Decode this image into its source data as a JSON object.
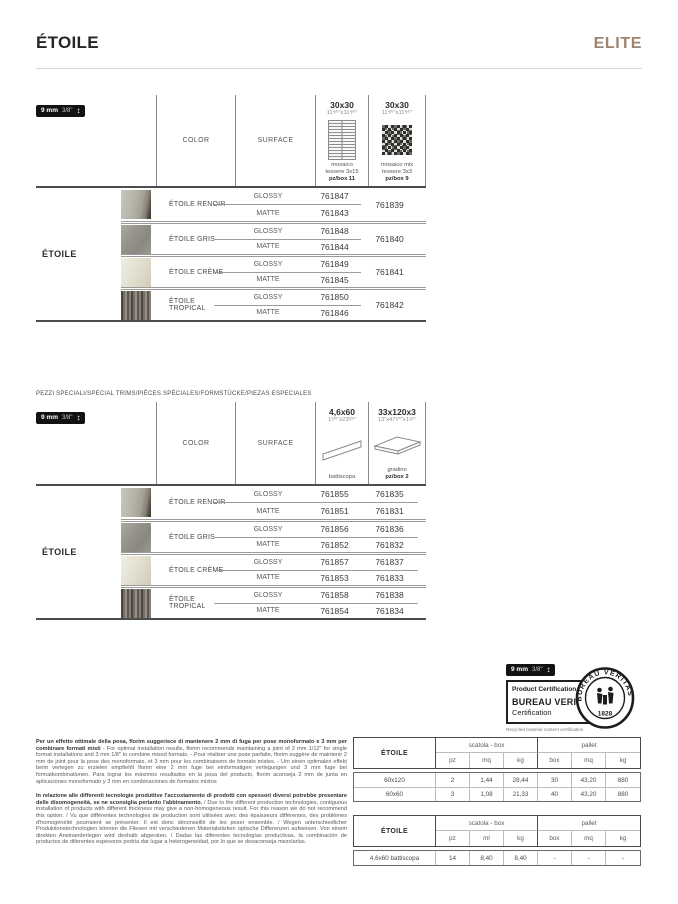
{
  "page": {
    "title": "ÉTOILE",
    "brand": "ELITE",
    "accent": "#9d8471"
  },
  "icons": {
    "thickness_arrow": "↕"
  },
  "thickness_badge": {
    "mm": "9 mm",
    "inch": "3/8\""
  },
  "labels": {
    "glossy": "GLOSSY",
    "matte": "MATTE"
  },
  "table1": {
    "series": "ÉTOILE",
    "columns": {
      "color": "COLOR",
      "surface": "SURFACE"
    },
    "formats": [
      {
        "size": "30x30",
        "inches": "11⁴⁄⁵\"x11⁴⁄⁵\"",
        "desc1": "mosaico",
        "desc2": "tessere 3x15",
        "box": "pz/box 11",
        "icon": "mosaic-strips-icon"
      },
      {
        "size": "30x30",
        "inches": "11⁴⁄⁵\"x11⁴⁄⁵\"",
        "desc1": "mosaico mix",
        "desc2": "tessere 3x3",
        "box": "pz/box 9",
        "icon": "mosaic-mix-icon"
      }
    ],
    "groups": [
      {
        "color": "ÉTOILE RENOIR",
        "swatch": "renoir",
        "glossy": "761847",
        "matte": "761843",
        "shared": "761839"
      },
      {
        "color": "ÉTOILE GRIS",
        "swatch": "gris",
        "glossy": "761848",
        "matte": "761844",
        "shared": "761840"
      },
      {
        "color": "ÉTOILE CRÈME",
        "swatch": "creme",
        "glossy": "761849",
        "matte": "761845",
        "shared": "761841"
      },
      {
        "color": "ÉTOILE TROPICAL",
        "swatch": "tropical",
        "glossy": "761850",
        "matte": "761846",
        "shared": "761842"
      }
    ]
  },
  "table2": {
    "title": "PEZZI SPECIALI/SPECIAL TRIMS/PIÈCES SPÉCIALES/FORMSTÜCKE/PIEZAS ESPECIALES",
    "series": "ÉTOILE",
    "columns": {
      "color": "COLOR",
      "surface": "SURFACE"
    },
    "formats": [
      {
        "size": "4,6x60",
        "inches": "1⁴⁄⁵\"x23³⁄⁵\"",
        "desc1": "battiscopa",
        "desc2": "",
        "box": "",
        "icon": "battiscopa-icon"
      },
      {
        "size": "33x120x3",
        "inches": "13\"x47¹⁄⁴\"x1¹⁄⁵\"",
        "desc1": "gradino",
        "desc2": "",
        "box": "pz/box 2",
        "icon": "gradino-icon"
      }
    ],
    "groups": [
      {
        "color": "ÉTOILE RENOIR",
        "swatch": "renoir",
        "glossy": [
          "761855",
          "761835"
        ],
        "matte": [
          "761851",
          "761831"
        ]
      },
      {
        "color": "ÉTOILE GRIS",
        "swatch": "gris",
        "glossy": [
          "761856",
          "761836"
        ],
        "matte": [
          "761852",
          "761832"
        ]
      },
      {
        "color": "ÉTOILE CRÈME",
        "swatch": "creme",
        "glossy": [
          "761857",
          "761837"
        ],
        "matte": [
          "761853",
          "761833"
        ]
      },
      {
        "color": "ÉTOILE TROPICAL",
        "swatch": "tropical",
        "glossy": [
          "761858",
          "761838"
        ],
        "matte": [
          "761854",
          "761834"
        ]
      }
    ]
  },
  "certification": {
    "line1": "Product Certification",
    "line2": "BUREAU VERITAS",
    "line3": "Certification",
    "sub": "Recycled material content certification",
    "seal_top": "BUREAU VERITAS",
    "seal_year": "1828"
  },
  "notes": [
    {
      "lead": "Per un effetto ottimale della posa, florim suggerisce di mantenere 2 mm di fuga per pose monoformato e 3 mm per combinare formati misti",
      "body": " - For optimal installation results, florim recommends maintaining a joint of 2 mm 1/12\" for single format installations and 3 mm 1/8\" to combine mixed formats. - Pour réaliser une pose parfaite, florim suggère de maintenir 2 mm de joint pour la pose des monoformats, et 3 mm pour les combinaisons de formats mixtes. - Um einen optimalen effekt beim verlegen zu erzielen empfiehlt florim eine 2 mm fuge bei einformatigen verlegungen und 3 mm fuge bei formatkombinationen. Para lograr los máximos resultados en la posa del producto, florim aconseja 2 mm de junta en aplicaciones monoformato y 3 mm en combinaciones de formatos mixtos"
    },
    {
      "lead": "In relazione alle differenti tecnologie produttive l'accostamento di prodotti con spessori diversi potrebbe presentare delle disomogeneità, se ne sconsiglia pertanto l'abbinamento.",
      "body": " / Due to the different production technologies, contiguous installation of products with different thickness may give a non-homogeneous result. For this reason we do not recommend this option. / Vu que différentes technologies de production sont utilisées avec des épaisseurs différentes, des problèmes d'homogénéité pourraient se présenter. Il est donc déconseillé de les poser ensemble. / Wegen unterschiedlicher Produktionstechnologien können die Fliesen mit verschiedenen Materialstärken optische Differenzen aufweisen. Von einem direkten Aneinanderlegen wird deshalb abgeraten. / Dadas las diferentes tecnologías productivas, la combinación de productos de diferentes espesores podría dar lugar a heterogeneidad, por lo que se desaconseja mezclarlas."
    }
  ],
  "packing_tables": [
    {
      "label": "ÉTOILE",
      "box_header": "scatola - box",
      "pallet_header": "pallet",
      "box_cols": [
        "pz",
        "mq",
        "kg"
      ],
      "pallet_cols": [
        "box",
        "mq",
        "kg"
      ],
      "rows": [
        {
          "name": "60x120",
          "values": [
            "2",
            "1,44",
            "28,44",
            "30",
            "43,20",
            "880"
          ]
        },
        {
          "name": "60x60",
          "values": [
            "3",
            "1,08",
            "21,33",
            "40",
            "43,20",
            "880"
          ]
        }
      ]
    },
    {
      "label": "ÉTOILE",
      "box_header": "scatola - box",
      "pallet_header": "pallet",
      "box_cols": [
        "pz",
        "ml",
        "kg"
      ],
      "pallet_cols": [
        "box",
        "mq",
        "kg"
      ],
      "rows": [
        {
          "name": "4,6x60 battiscopa",
          "values": [
            "14",
            "8,40",
            "8,40",
            "-",
            "-",
            "-"
          ]
        }
      ]
    }
  ]
}
